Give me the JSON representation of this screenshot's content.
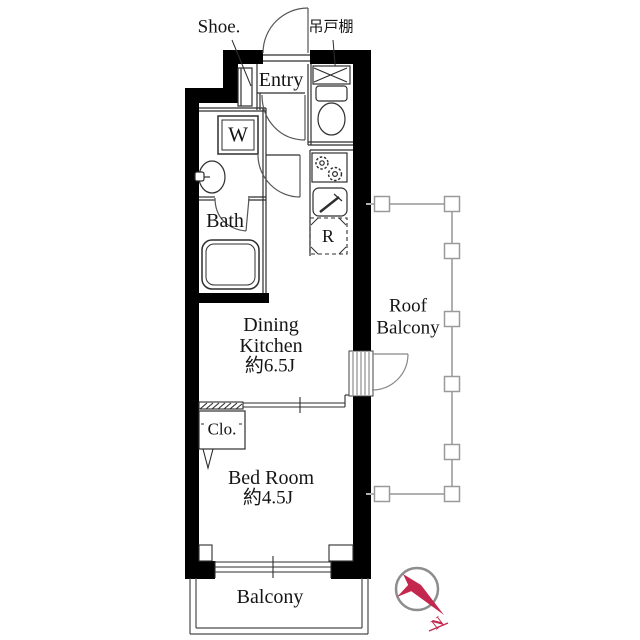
{
  "plan": {
    "rooms": {
      "entry": "Entry",
      "bath": "Bath",
      "dining_kitchen": [
        "Dining",
        "Kitchen",
        "約6.5J"
      ],
      "bedroom": [
        "Bed Room",
        "約4.5J"
      ],
      "roof_balcony": [
        "Roof",
        "Balcony"
      ],
      "balcony": "Balcony",
      "closet": "Clo."
    },
    "fixtures": {
      "shoe_cabinet": "Shoe.",
      "hanging_cupboard": "吊戸棚",
      "washer": "W",
      "refrigerator": "R"
    },
    "compass": {
      "north": "N"
    },
    "colors": {
      "wall": "#000000",
      "thin_line": "#2e2e2e",
      "railing": "#b0b0b0",
      "compass_ring": "#8d8d8d",
      "compass_red": "#c4274e",
      "background": "#ffffff"
    }
  }
}
